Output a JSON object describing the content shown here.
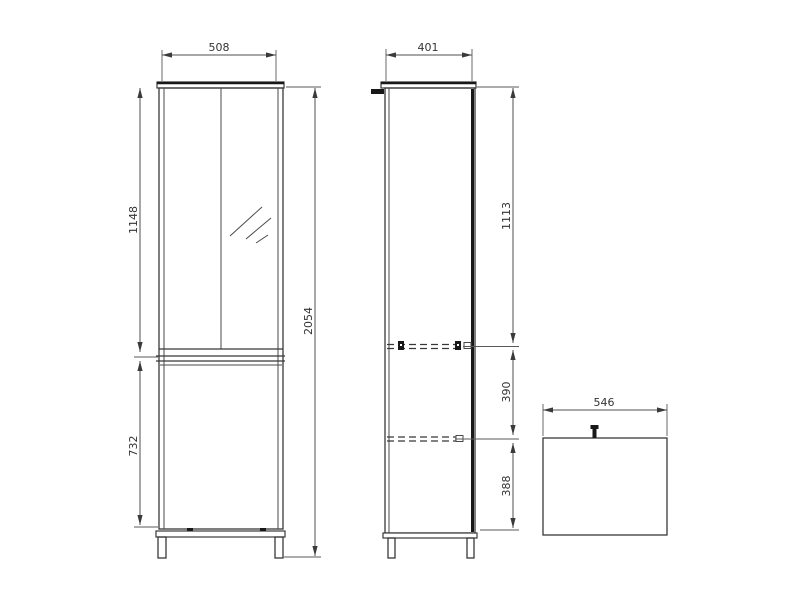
{
  "page": {
    "background_color": "#ffffff",
    "line_color": "#383838",
    "dimension_text_color": "#333333"
  },
  "drawing": {
    "description": "technical-dimension-drawing-tall-mirror-cabinet-three-views",
    "front_view": {
      "width": "508",
      "upper_door_height": "1148",
      "lower_door_height": "732",
      "total_height": "2054"
    },
    "side_view": {
      "depth": "401",
      "top_to_first_shelf": "1113",
      "shelf_spacing": "390",
      "shelf_to_bottom": "388"
    },
    "top_view": {
      "width": "546"
    }
  }
}
